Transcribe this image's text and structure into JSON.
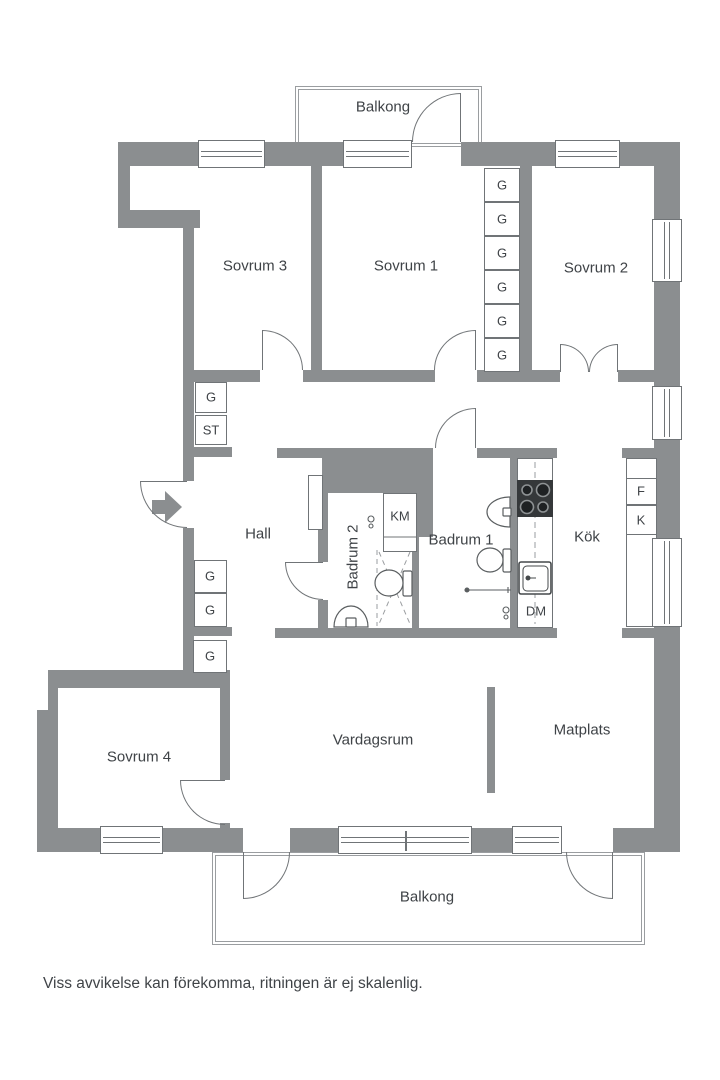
{
  "plan": {
    "rooms": {
      "balkong_top": "Balkong",
      "sovrum3": "Sovrum 3",
      "sovrum1": "Sovrum 1",
      "sovrum2": "Sovrum 2",
      "hall": "Hall",
      "badrum2": "Badrum 2",
      "badrum1": "Badrum 1",
      "kok": "Kök",
      "sovrum4": "Sovrum 4",
      "vardagsrum": "Vardagsrum",
      "matplats": "Matplats",
      "balkong_bottom": "Balkong"
    },
    "fixtures": {
      "g": "G",
      "st": "ST",
      "km": "KM",
      "dm": "DM",
      "f": "F",
      "k": "K"
    },
    "footer": "Viss avvikelse kan förekomma, ritningen är ej skalenlig.",
    "colors": {
      "wall": "#8b8e90",
      "line": "#707477",
      "text": "#3f4347"
    }
  }
}
